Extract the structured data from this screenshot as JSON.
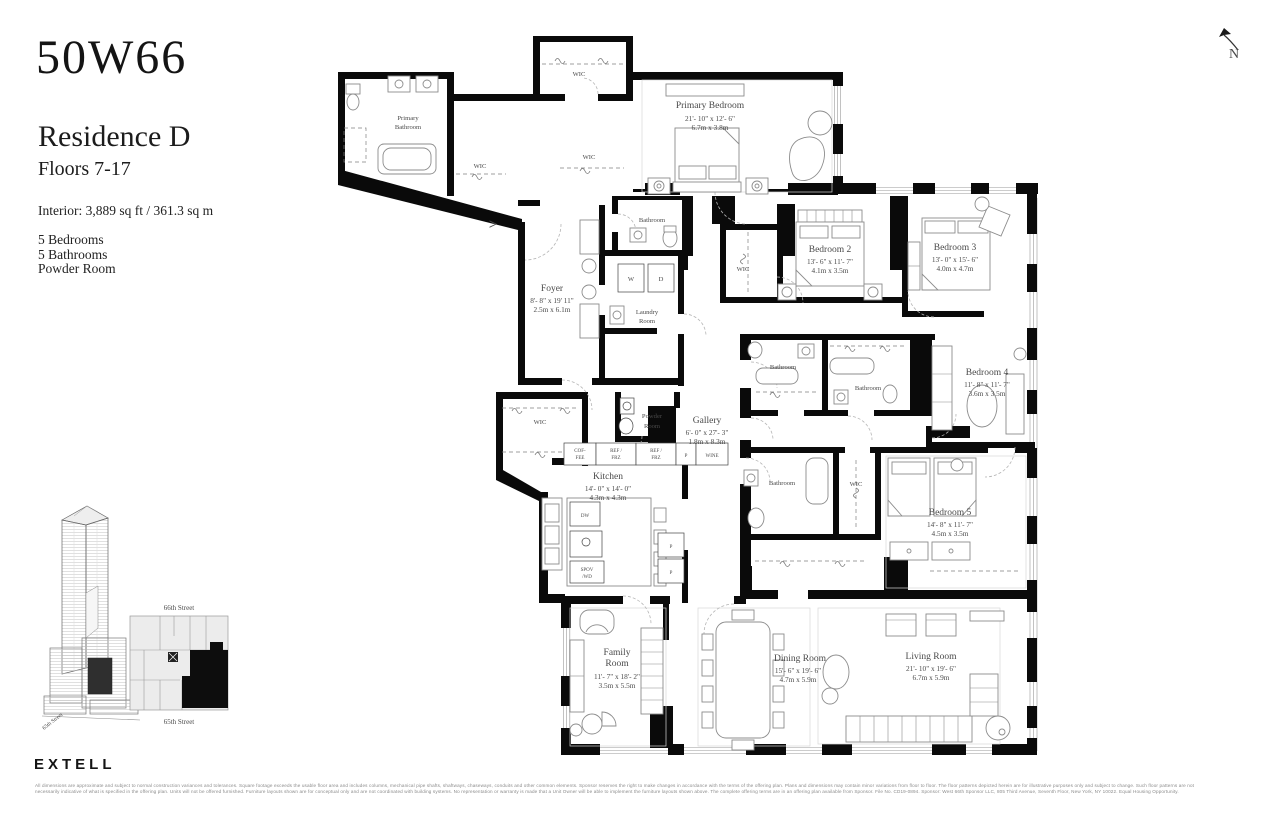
{
  "header": {
    "brand": "50W66",
    "residence": "Residence D",
    "floors": "Floors 7-17",
    "interior": "Interior: 3,889 sq ft / 361.3 sq m",
    "features": [
      "5 Bedrooms",
      "5 Bathrooms",
      "Powder Room"
    ]
  },
  "compass": {
    "label": "N"
  },
  "plan": {
    "entry_arrow": ">",
    "rooms": {
      "primary_bathroom": {
        "l1": "Primary",
        "l2": "Bathroom"
      },
      "primary_bedroom": {
        "name": "Primary Bedroom",
        "ft": "21'- 10\" x 12'- 6\"",
        "m": "6.7m x 3.8m"
      },
      "foyer": {
        "name": "Foyer",
        "ft": "8'- 8\" x 19' 11\"",
        "m": "2.5m x 6.1m"
      },
      "bathroom": {
        "name": "Bathroom"
      },
      "laundry": {
        "l1": "Laundry",
        "l2": "Room"
      },
      "powder": {
        "l1": "Powder",
        "l2": "Room"
      },
      "gallery": {
        "name": "Gallery",
        "ft": "6'- 0\" x 27'- 3\"",
        "m": "1.8m x 8.3m"
      },
      "kitchen": {
        "name": "Kitchen",
        "ft": "14'- 0\" x 14'- 0\"",
        "m": "4.3m x 4.3m"
      },
      "bedroom2": {
        "name": "Bedroom 2",
        "ft": "13'- 6\" x 11'- 7\"",
        "m": "4.1m x 3.5m"
      },
      "bedroom3": {
        "name": "Bedroom 3",
        "ft": "13'- 0\" x 15'- 6\"",
        "m": "4.0m x 4.7m"
      },
      "bedroom4": {
        "name": "Bedroom 4",
        "ft": "11'- 8\" x 11'- 7\"",
        "m": "3.6m x 3.5m"
      },
      "bedroom5": {
        "name": "Bedroom 5",
        "ft": "14'- 8\" x 11'- 7\"",
        "m": "4.5m x 3.5m"
      },
      "family": {
        "l1": "Family",
        "l2": "Room",
        "ft": "11'- 7\" x 18'- 2\"",
        "m": "3.5m x 5.5m"
      },
      "dining": {
        "name": "Dining Room",
        "ft": "15'- 6\" x 19'- 6\"",
        "m": "4.7m x 5.9m"
      },
      "living": {
        "name": "Living Room",
        "ft": "21'- 10\" x 19'- 6\"",
        "m": "6.7m x 5.9m"
      }
    },
    "labels": {
      "wic": "WIC",
      "w": "W",
      "d": "D",
      "dw": "DW",
      "p": "P",
      "wine": "WINE",
      "coffee_l1": "COF-",
      "coffee_l2": "FEE",
      "ref_l1": "REF /",
      "ref_l2": "FRZ",
      "spov_l1": "SPOV",
      "spov_l2": "/WD"
    }
  },
  "locator": {
    "street_top": "66th Street",
    "street_bottom": "65th Street",
    "street_side": "65th Street"
  },
  "footer": {
    "logo": "EXTELL",
    "legal_line1": "All dimensions are approximate and subject to normal construction variances and tolerances. Square footage exceeds the usable floor area and includes columns, mechanical pipe shafts, shaftways, chaseways, conduits and other common elements. Sponsor reserves the right to make changes in accordance with the terms of the offering plan. Plans and dimensions may contain minor variations from floor to floor. The floor patterns depicted herein are for illustrative purposes only and subject to change. Such floor patterns are not",
    "legal_line2": "necessarily indicative of what is specified in the offering plan. Units will not be offered furnished. Furniture layouts shown are for conceptual only and are not coordinated with building systems. No representation or warranty is made that a Unit Owner will be able to implement the furniture layouts shown above. The complete offering terms are in an offering plan available from Sponsor. File No. CD19-0894. Sponsor: West 66th Sponsor LLC, 805 Third Avenue, Seventh Floor, New York, NY 10022. Equal Housing Opportunity."
  }
}
